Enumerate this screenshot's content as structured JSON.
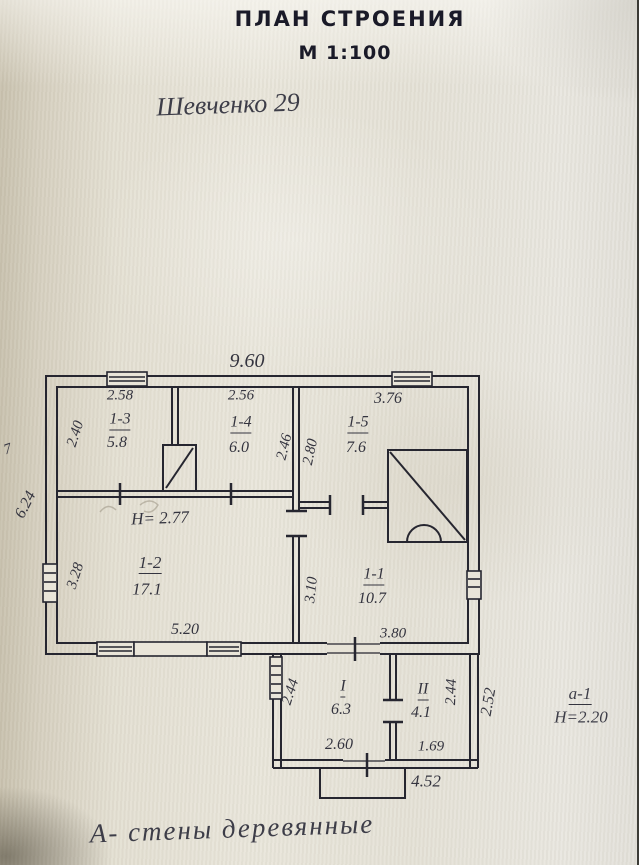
{
  "title": "ПЛАН СТРОЕНИЯ",
  "scale": "М 1:100",
  "address": "Шевченко 29",
  "note": "А- стены деревянные",
  "margin_mark": "7",
  "ceiling_height_main": "H= 2.77",
  "annex_ref": {
    "id": "а-1",
    "height": "H=2.20"
  },
  "rooms": [
    {
      "id": "1-3",
      "area": "5.8",
      "width": "2.58",
      "depth": "2.40"
    },
    {
      "id": "1-4",
      "area": "6.0",
      "width": "2.56",
      "depth": "2.46"
    },
    {
      "id": "1-5",
      "area": "7.6",
      "width": "3.76",
      "depth": "2.80"
    },
    {
      "id": "1-2",
      "area": "17.1",
      "width": "5.20",
      "depth": "3.28"
    },
    {
      "id": "1-1",
      "area": "10.7",
      "width": "3.80",
      "depth": "3.10"
    },
    {
      "id": "I",
      "area": "6.3",
      "width": "2.60",
      "depth": "2.44"
    },
    {
      "id": "II",
      "area": "4.1",
      "width": "1.69",
      "depth": "2.44"
    }
  ],
  "dimensions": {
    "top_total": "9.60",
    "left_total": "6.24",
    "annex_right_outer": "2.52",
    "annex_bottom_total": "4.52"
  },
  "colors": {
    "ink": "#262630",
    "pencil": "#34343f",
    "paper": "#e7e3d7"
  }
}
